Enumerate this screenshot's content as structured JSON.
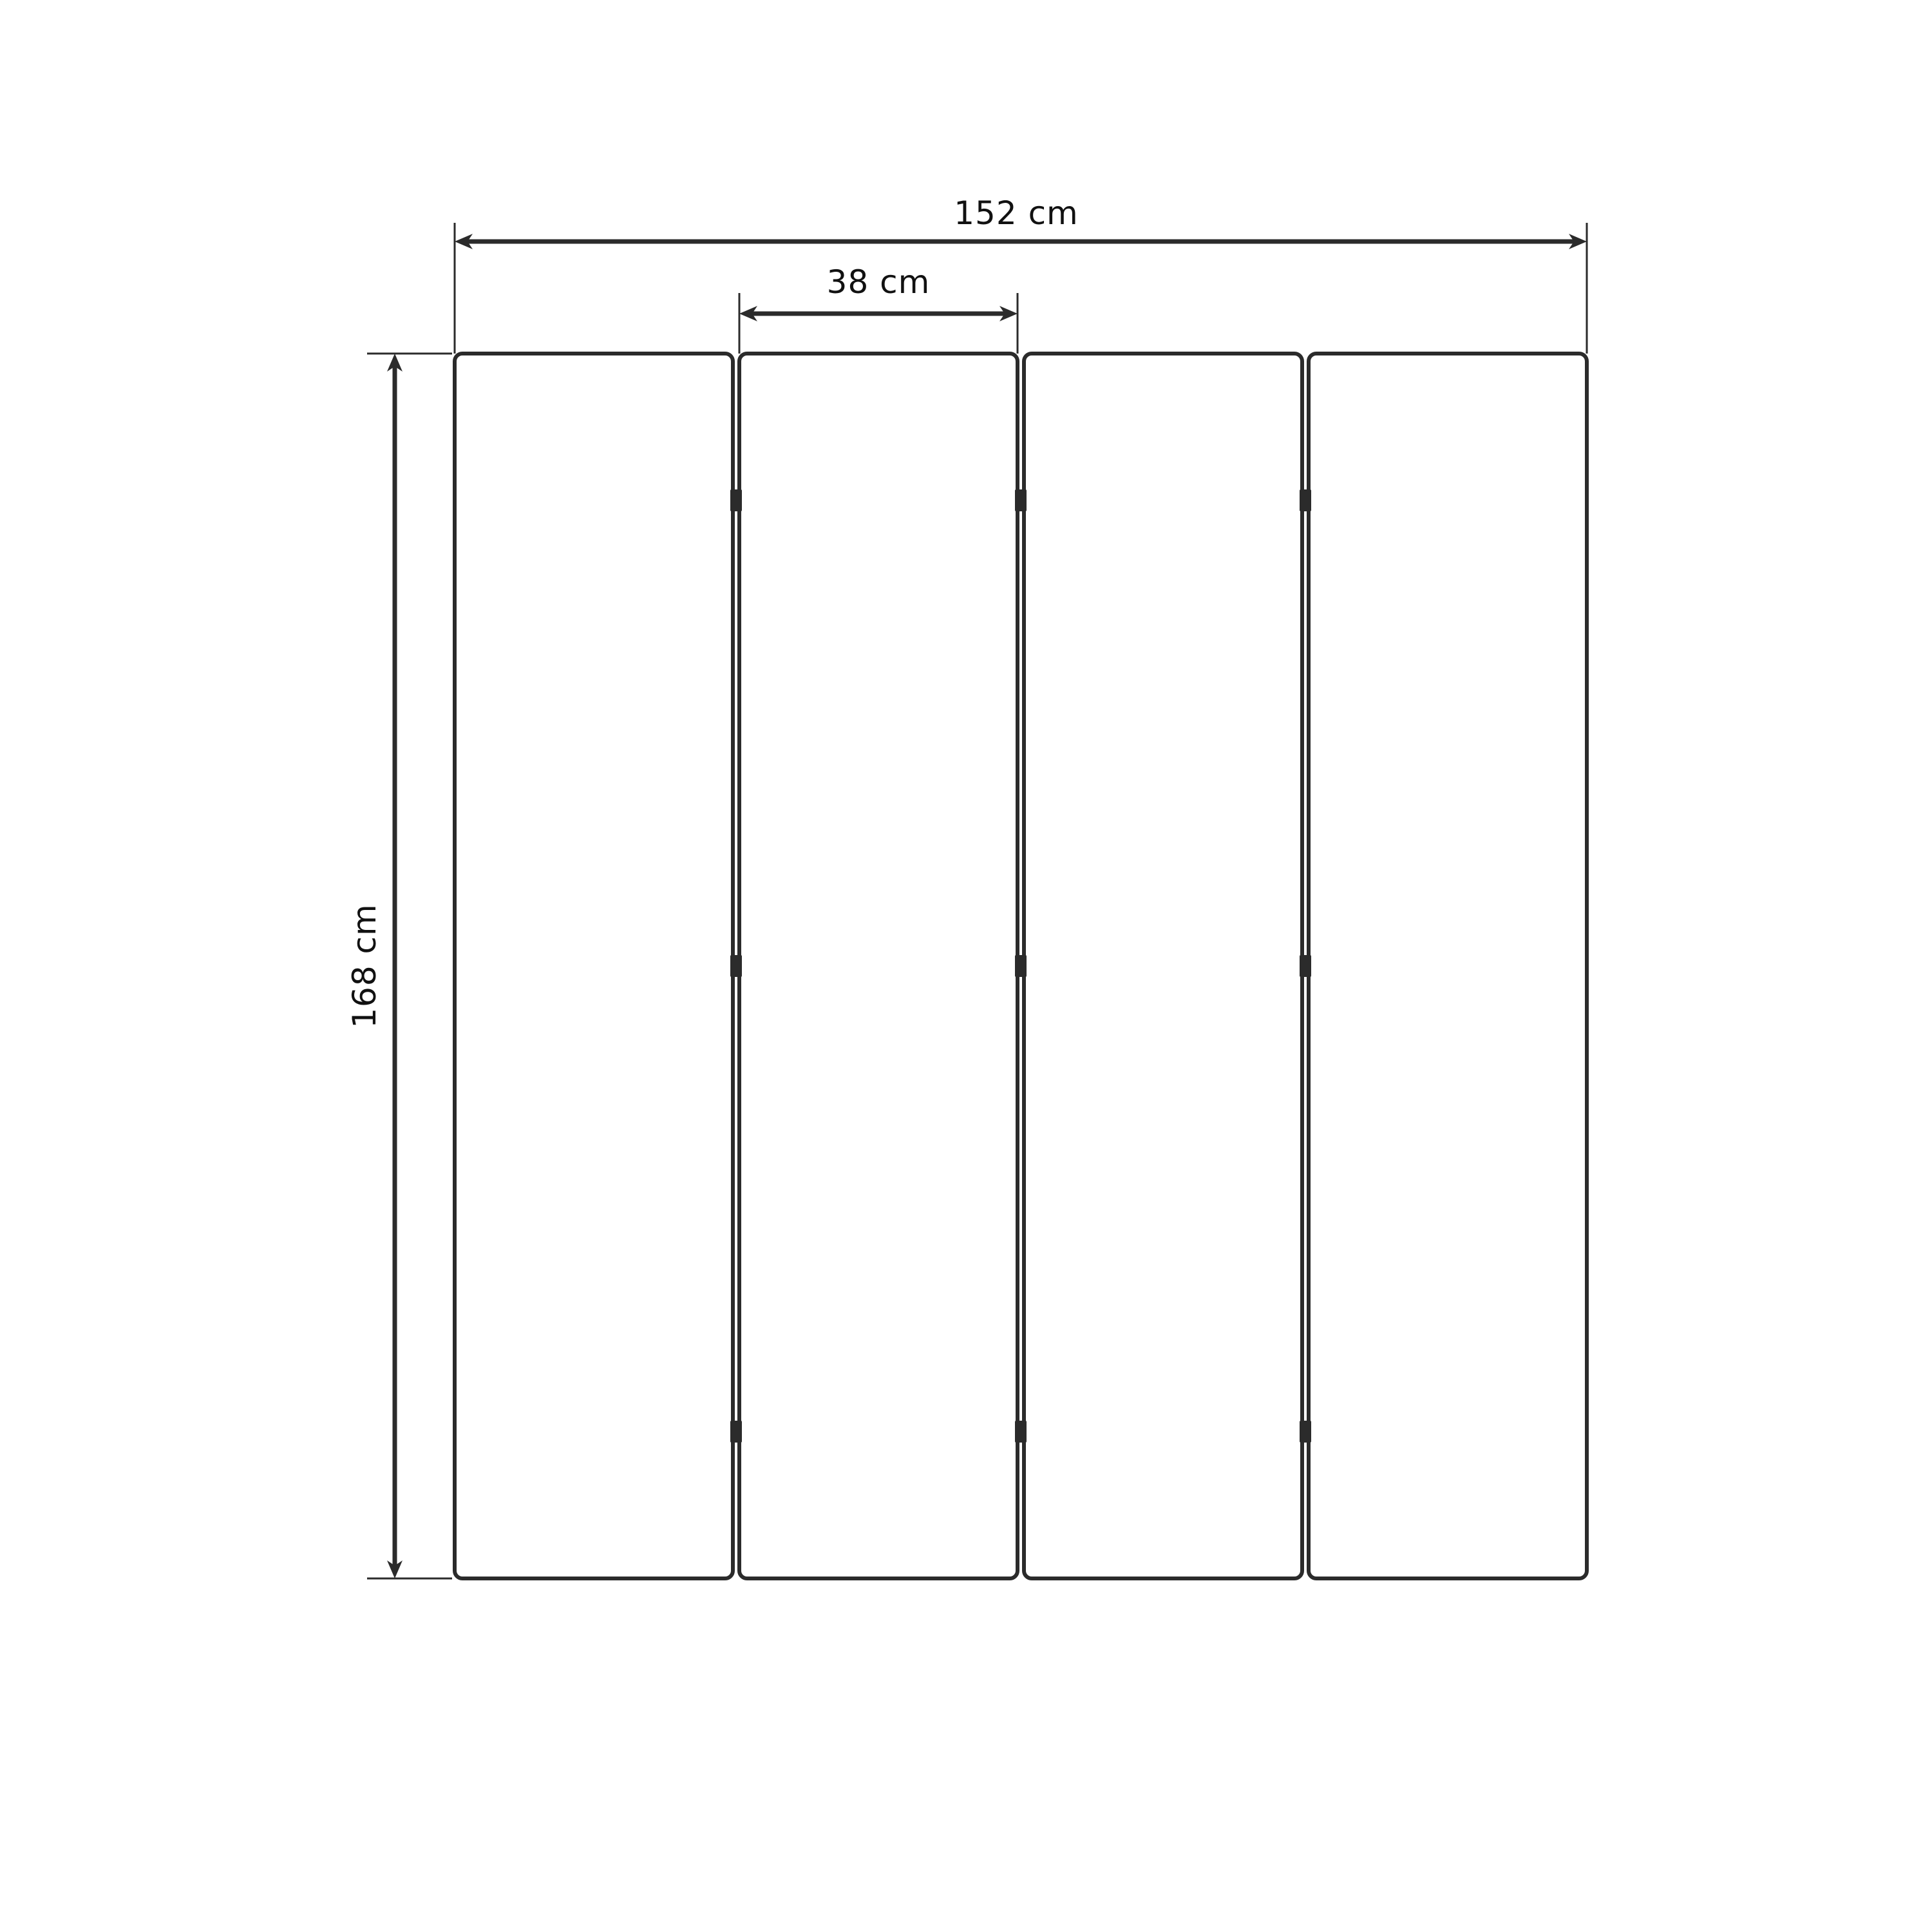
{
  "drawing": {
    "kind": "folding-screen-dimension-diagram",
    "panels": {
      "count": 4,
      "hinge_rows": 3,
      "hinge_marks_total": 9
    },
    "dimensions": {
      "total_width": {
        "label": "152 cm"
      },
      "panel_width": {
        "label": "38 cm"
      },
      "height": {
        "label": "168 cm"
      }
    },
    "colors": {
      "line": "#2b2b2b",
      "text": "#111111",
      "background": "#ffffff",
      "panel_fill": "#ffffff"
    }
  }
}
